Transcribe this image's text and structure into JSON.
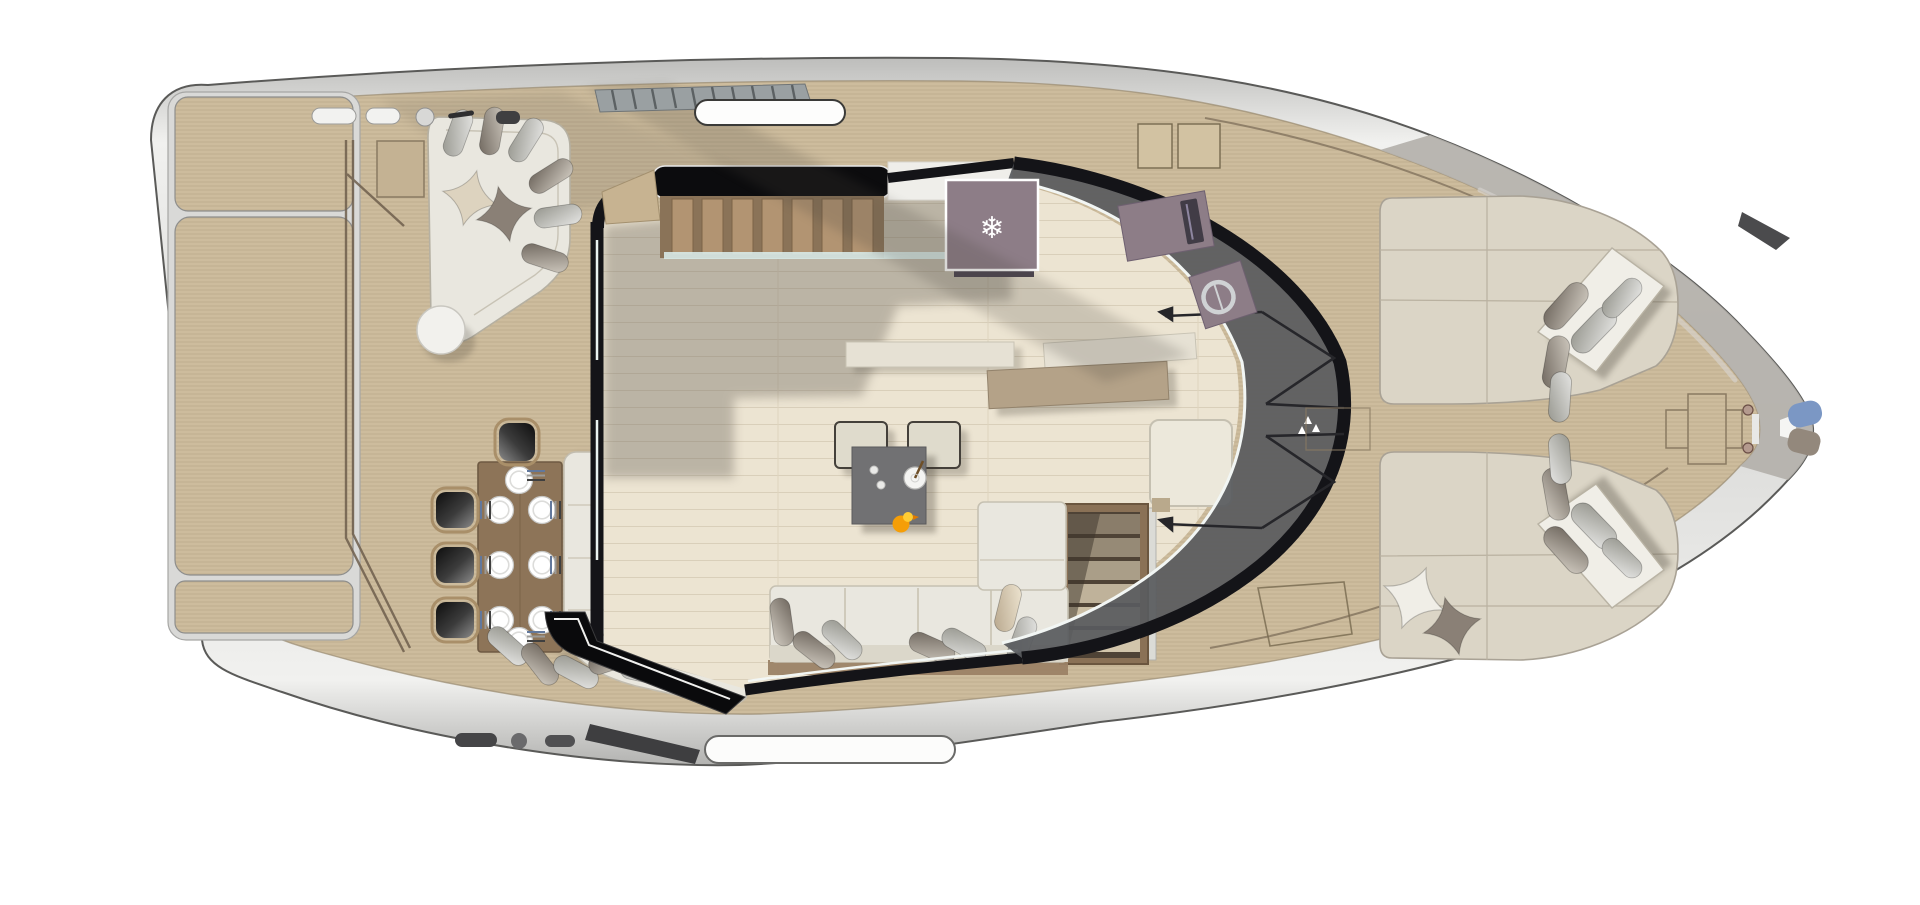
{
  "palette": {
    "background": "#ffffff",
    "hull_silver": "#d7d7d5",
    "hull_outline": "#5a5a58",
    "hull_bow_gray": "#b2afaa",
    "deck_teak": "#cdbc9d",
    "deck_seam": "#6f5f4d",
    "interior_floor": "#ece4d2",
    "plank_line": "#d9cfba",
    "interior_shadow": "#6e675d",
    "superstructure_dark": "#141418",
    "trim_white": "#f2f6f4",
    "glass_tint": "#595b5f",
    "glass_teal": "#d7e9e7",
    "cushion_light": "#e9e7df",
    "cushion_border": "#c2bdb0",
    "backrest_white": "#f0eee7",
    "pillow_dark": "#8a8076",
    "pillow_silver": "#b9b9b9",
    "pillow_cream": "#ddd3bf",
    "wood_table": "#8d7458",
    "wood_dark": "#6e5a43",
    "chair_frame": "#a98f69",
    "stairs_tread": "#b29472",
    "stairs_dark": "#8a7358",
    "companion_frame": "#8a7156",
    "companion_tread": "#d2c5ab",
    "galley_counter": "#e6e1d4",
    "galley_island": "#b4a288",
    "appliance_purple": "#8d7d87",
    "console_dark": "#413c46",
    "coffee_table": "#717173",
    "ottoman": "#dfdbcc",
    "duck_orange": "#f59e07",
    "duck_yellow": "#ffcc33",
    "anchor_blue": "#7b97c4",
    "anchor_gray": "#93887c",
    "sofa_base_wood": "#9b8266"
  },
  "icons": {
    "snowflake": "❄"
  },
  "scene": {
    "type": "yacht-deck-floorplan-top-view",
    "place_settings": 8,
    "dining_chairs": 4,
    "bow_sunpads": 2
  }
}
